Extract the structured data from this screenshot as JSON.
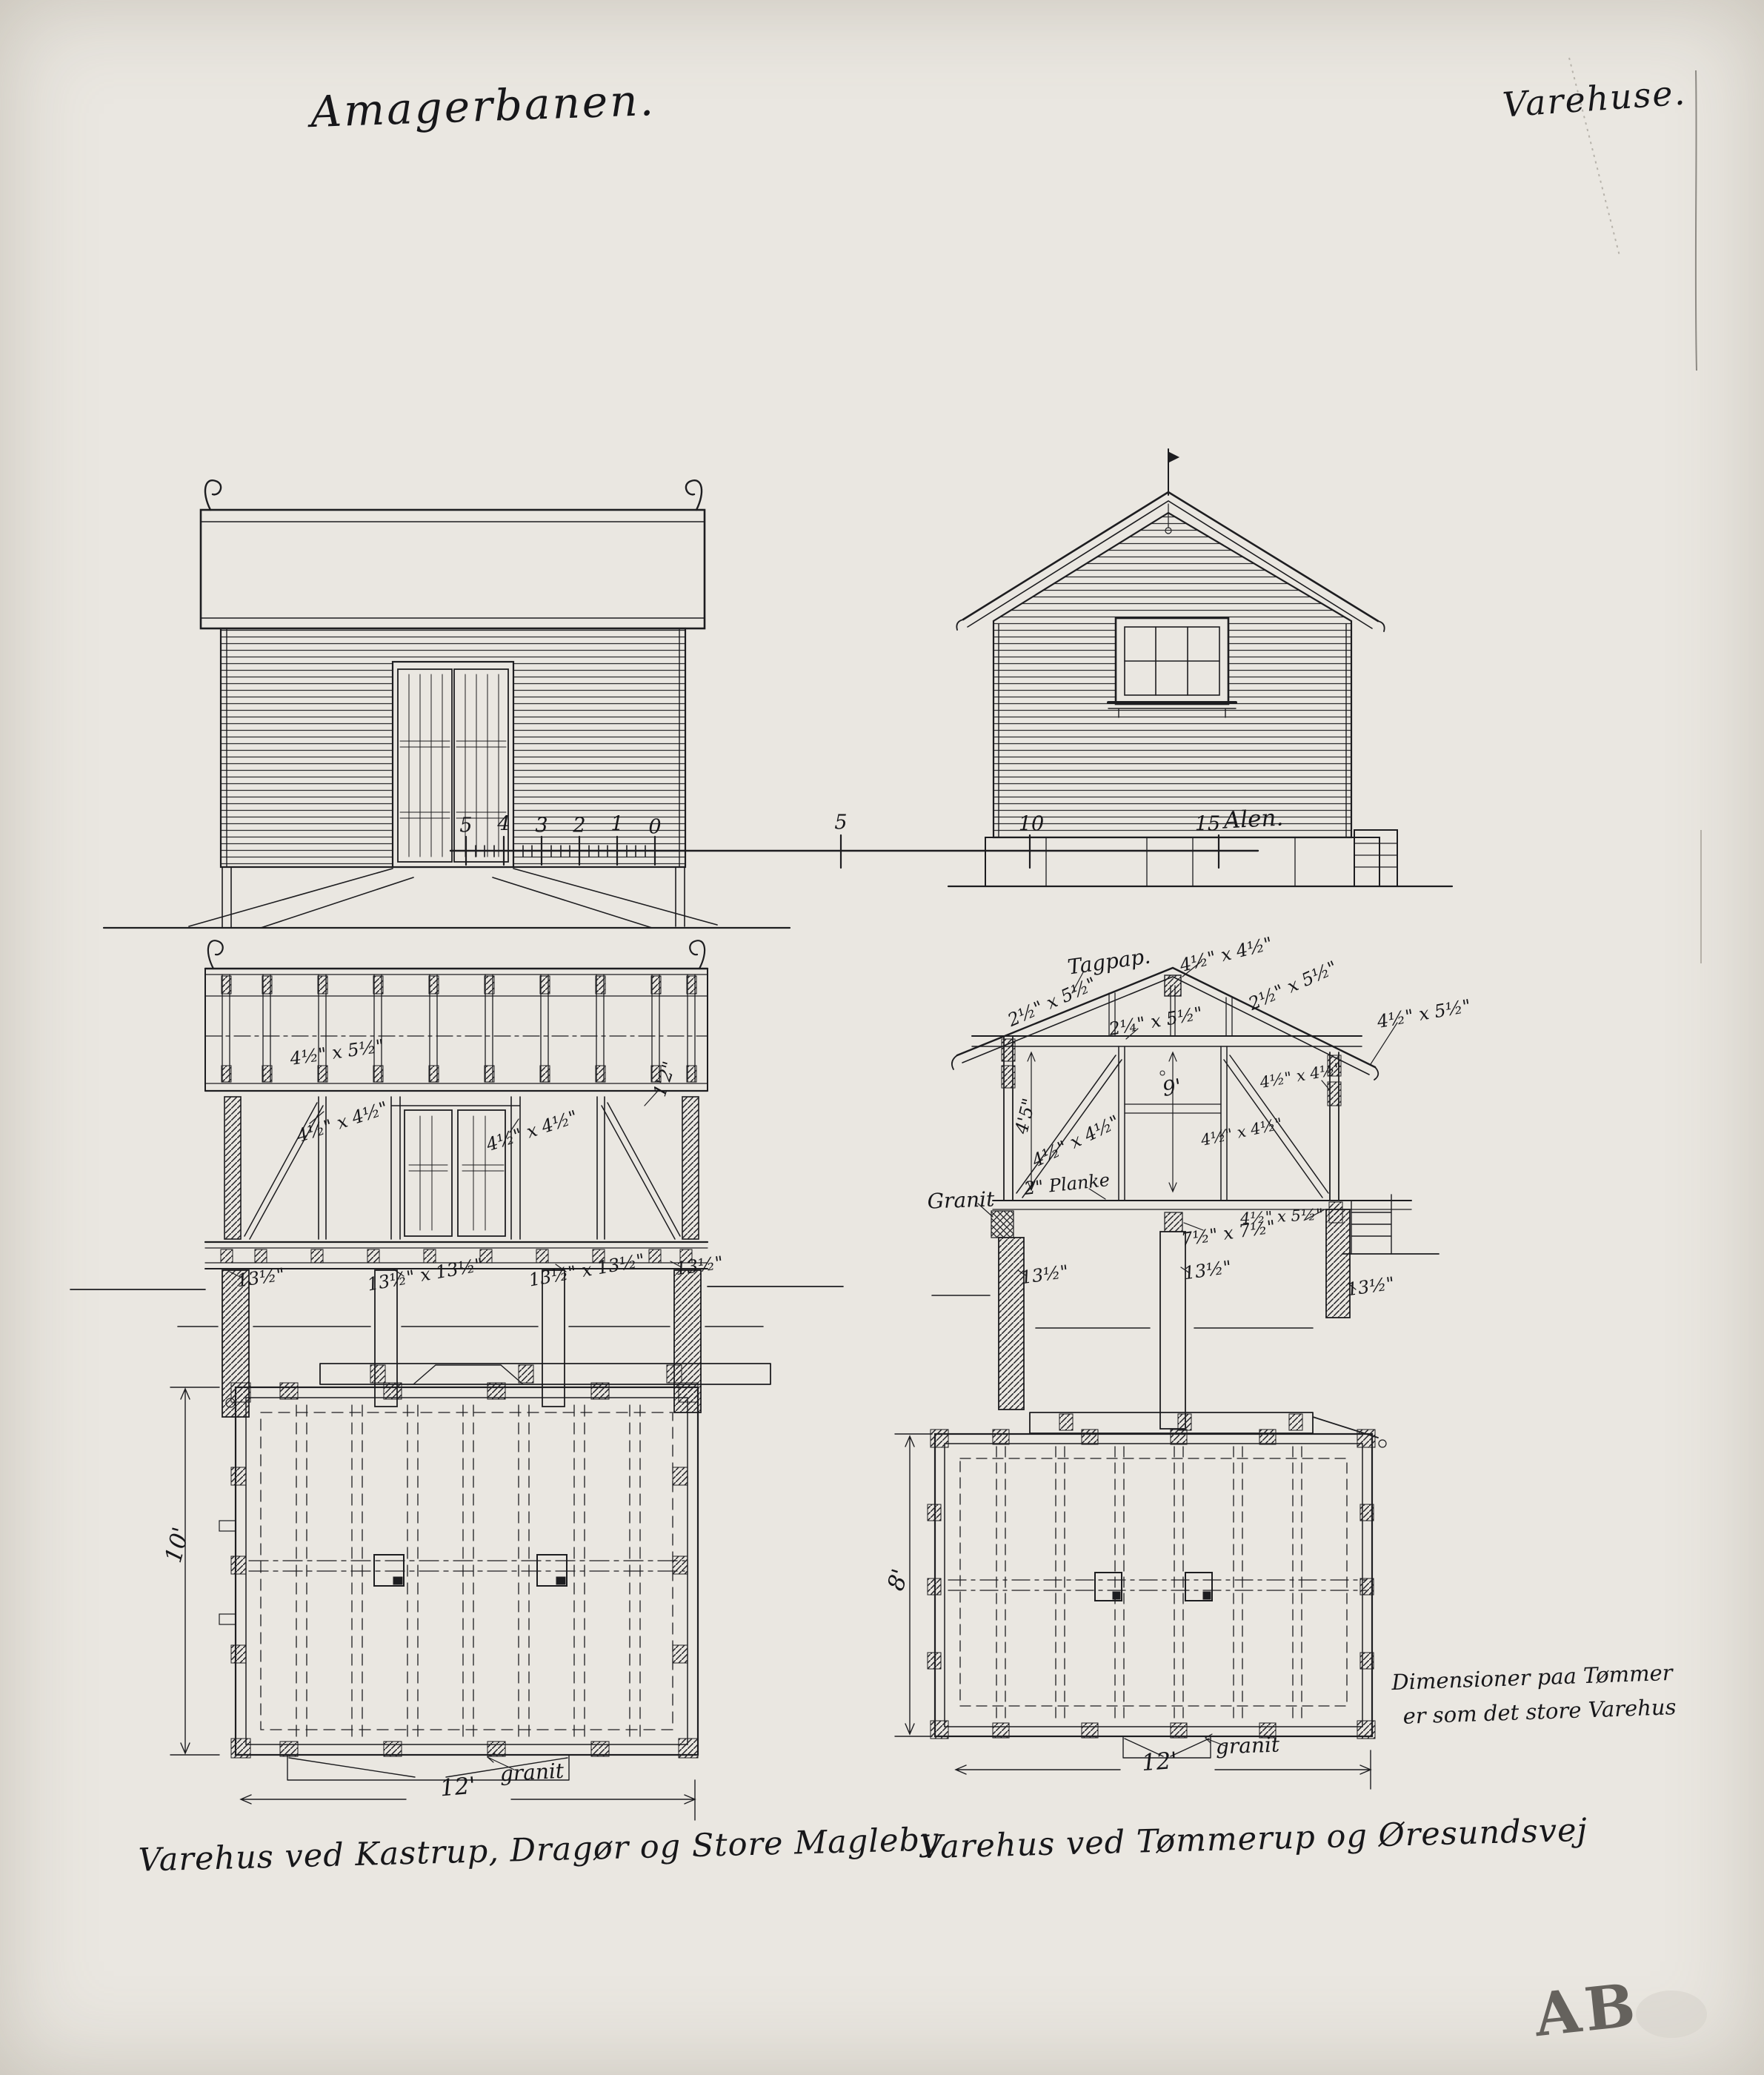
{
  "titles": {
    "left": "Amagerbanen.",
    "right": "Varehuse."
  },
  "scale_bar": {
    "minor_labels": [
      "5",
      "4",
      "3",
      "2",
      "1",
      "0"
    ],
    "major_labels": [
      "5",
      "10",
      "15"
    ],
    "unit": "Alen."
  },
  "sections": {
    "left": {
      "top_beam": "4½\" x 5½\"",
      "left_stud": "4½\" x 4½\"",
      "right_stud": "4½\" x 4½\"",
      "eave": "1'2\"",
      "post1": "13½\"",
      "post2": "13½\" x 13½\"",
      "post3": "13½\" x 13½\"",
      "post4": "13½\""
    },
    "right": {
      "tagpap": "Tagpap.",
      "ridge": "4½\" x 4½\"",
      "rafter_left": "2½\" x 5½\"",
      "rafter_right": "2½\" x 5½\"",
      "tie_beam": "2¼\" x 5½\"",
      "eave_right": "4½\" x 5½\"",
      "wall_right": "4½\" x 4½\"",
      "height_left": "4'5\"",
      "diagonal": "4½\" x 4½\"",
      "height_mid": "9'",
      "mid_post": "4½\" x 4½\"",
      "planke": "2\" Planke",
      "granit": "Granit",
      "floor_beam": "4½\" x 5½\"",
      "footing": "7½\" x 7½\"",
      "post1": "13½\"",
      "post2": "13½\"",
      "post3": "13½\""
    }
  },
  "plans": {
    "left": {
      "height": "10'",
      "width": "12'",
      "granit": "granit"
    },
    "right": {
      "height": "8'",
      "width": "12'",
      "granit": "granit"
    }
  },
  "captions": {
    "left": "Varehus ved Kastrup, Dragør og Store Magleby",
    "right": "Varehus ved Tømmerup og Øresundsvej"
  },
  "note": {
    "line1": "Dimensioner paa Tømmer",
    "line2": "er som det store Varehus"
  },
  "stamp": "AB"
}
